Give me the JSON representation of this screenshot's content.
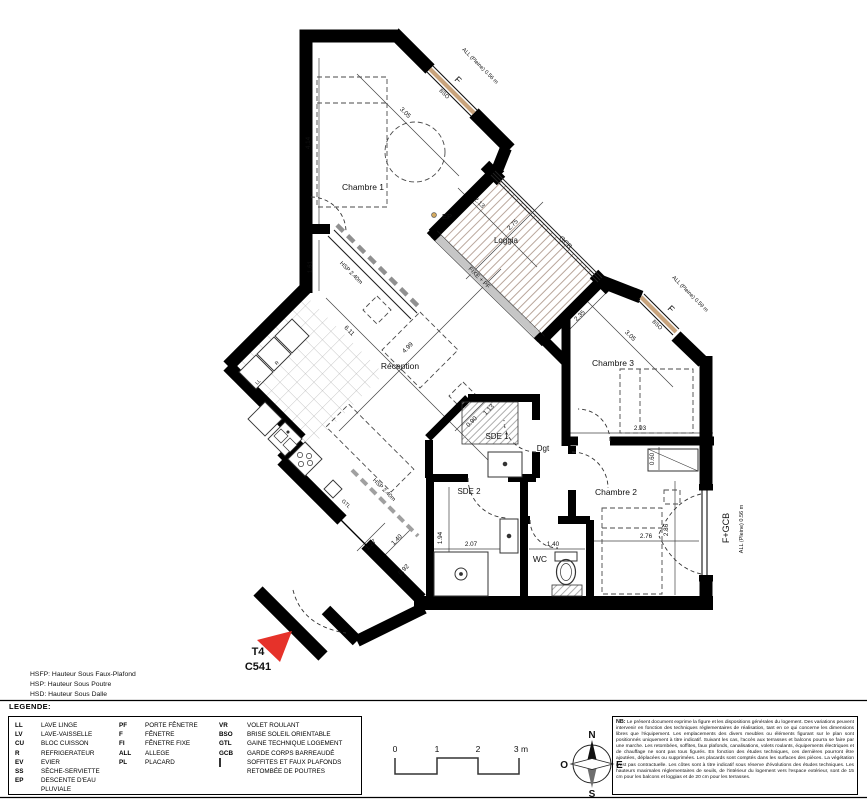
{
  "plan": {
    "unit": {
      "type_label": "T4",
      "lot_label": "C541"
    },
    "rooms": {
      "chambre1": "Chambre 1",
      "loggia": "Loggia",
      "reception": "Réception",
      "chambre3": "Chambre 3",
      "sde1": "SDE 1",
      "dgt": "Dgt",
      "sde2": "SDE 2",
      "chambre2": "Chambre 2",
      "wc": "WC"
    },
    "dims": [
      "4.14",
      "1.61",
      "3.05",
      "HSP 2.40m",
      "6.11",
      "4.99",
      "2.13",
      "2.75",
      "2.35",
      "3.05",
      "2.93",
      "0.60",
      "2.76",
      "2.86",
      "0.90",
      "1.13",
      "2.07",
      "1.94",
      "1.40",
      "1.27",
      "1.40",
      "0.92",
      "HSP 2.40m"
    ],
    "annotations": {
      "ep": "EP",
      "f1": "F",
      "bso1": "BSO",
      "all_top": "ALL (Pleine) 0.56 m",
      "f2": "F",
      "bso2": "BSO",
      "all_ch3": "ALL (Pleine) 0.59 m",
      "fgcb": "F+GCB",
      "all_right": "ALL (Pleine) 0.56 m",
      "gcb": "GCB",
      "fixe_pf": "FIXE + PF",
      "gtl": "GTL",
      "ll": "LL",
      "r": "R"
    }
  },
  "hs_notes": {
    "hsfp": "HSFP: Hauteur Sous Faux-Plafond",
    "hsp": "HSP: Hauteur Sous Poutre",
    "hsd": "HSD: Hauteur Sous Dalle"
  },
  "legend": {
    "title": "LEGENDE:",
    "col1": [
      {
        "abbr": "LL",
        "label": "LAVE LINGE"
      },
      {
        "abbr": "LV",
        "label": "LAVE-VAISSELLE"
      },
      {
        "abbr": "CU",
        "label": "BLOC CUISSON"
      },
      {
        "abbr": "R",
        "label": "REFRIGERATEUR"
      },
      {
        "abbr": "EV",
        "label": "EVIER"
      },
      {
        "abbr": "SS",
        "label": "SÈCHE-SERVIETTE"
      },
      {
        "abbr": "EP",
        "label": "DESCENTE D'EAU"
      },
      {
        "abbr": "",
        "label": "PLUVIALE"
      }
    ],
    "col2": [
      {
        "abbr": "PF",
        "label": "PORTE FÊNETRE"
      },
      {
        "abbr": "F",
        "label": "FÊNETRE"
      },
      {
        "abbr": "FI",
        "label": "FÊNETRE FIXE"
      },
      {
        "abbr": "ALL",
        "label": "ALLEGE"
      },
      {
        "abbr": "PL",
        "label": "PLACARD"
      }
    ],
    "col3": [
      {
        "abbr": "VR",
        "label": "VOLET ROULANT"
      },
      {
        "abbr": "BSO",
        "label": "BRISE SOLEIL ORIENTABLE"
      },
      {
        "abbr": "GTL",
        "label": "GAINE TECHNIQUE LOGEMENT"
      },
      {
        "abbr": "GCB",
        "label": "GARDE CORPS BARREAUDÉ"
      },
      {
        "abbr": "",
        "label": "SOFFITES ET FAUX PLAFONDS",
        "swatch": "hatch"
      },
      {
        "abbr": "",
        "label": "RETOMBÉE DE POUTRES",
        "swatch": "line"
      }
    ]
  },
  "scale_bar": {
    "t0": "0",
    "t1": "1",
    "t2": "2",
    "t3": "3 m"
  },
  "compass": {
    "north": "N",
    "south": "S",
    "east": "E",
    "west": "O"
  },
  "nb": {
    "prefix": "NB:",
    "text": " Le présent document exprime la figure et les dispositions générales du logement. Des variations peuvent intervenir en fonction des techniques réglementaires de réalisation, tant en ce qui concerne les dimensions libres que l'équipement. Les emplacements des divers meubles ou éléments figurant sur le plan sont positionnés uniquement à titre indicatif. Suivant les cas, l'accès aux terrasses et balcons pourra se faire par une marche. Les retombées, soffites, faux plafonds, canalisations, volets roulants, équipements électriques et de chauffage ne sont pas tous figurés. En fonction des études techniques, ces dernières pourront être ajoutées, déplacées ou supprimées. Les placards sont comptés dans les surfaces des pièces. La végétation n'est pas contractuelle. Les côtes sont à titre indicatif sous réserve d'évolutions des études techniques. Les hauteurs maximales réglementaires de seuils, de l'intérieur du logement vers l'espace extérieur, sont de 15 cm pour les balcons et loggias et de 20 cm pour les terrasses."
  }
}
